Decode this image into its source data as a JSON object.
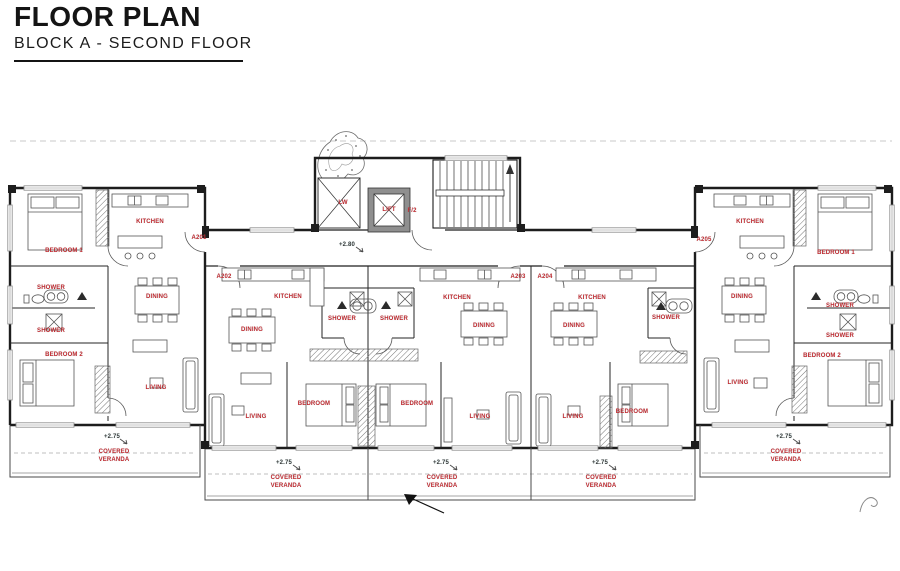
{
  "header": {
    "title": "FLOOR PLAN",
    "subtitle": "BLOCK A - SECOND FLOOR"
  },
  "colors": {
    "label_red": "#c1272d",
    "line_black": "#1d1d1d"
  },
  "core": {
    "light_well": "LW",
    "lift": "LIFT",
    "fire_door": "F/2",
    "corridor_elevation": "+2.80"
  },
  "apartments": [
    {
      "number": "A201",
      "rooms": {
        "bedroom1": "BEDROOM 1",
        "kitchen": "KITCHEN",
        "shower_top": "SHOWER",
        "dining": "DINING",
        "shower_bottom": "SHOWER",
        "bedroom2": "BEDROOM 2",
        "living": "LIVING"
      },
      "veranda": {
        "elevation": "+2.75",
        "label": "COVERED VERANDA"
      }
    },
    {
      "number": "A202",
      "rooms": {
        "kitchen": "KITCHEN",
        "shower": "SHOWER",
        "dining": "DINING",
        "bedroom": "BEDROOM",
        "living": "LIVING"
      },
      "veranda": {
        "elevation": "+2.75",
        "label": "COVERED VERANDA"
      }
    },
    {
      "number": "A203",
      "rooms": {
        "kitchen": "KITCHEN",
        "shower": "SHOWER",
        "dining": "DINING",
        "bedroom": "BEDROOM",
        "living": "LIVING"
      },
      "veranda": {
        "elevation": "+2.75",
        "label": "COVERED VERANDA"
      }
    },
    {
      "number": "A204",
      "rooms": {
        "kitchen": "KITCHEN",
        "shower": "SHOWER",
        "dining": "DINING",
        "bedroom": "BEDROOM",
        "living": "LIVING"
      },
      "veranda": {
        "elevation": "+2.75",
        "label": "COVERED VERANDA"
      }
    },
    {
      "number": "A205",
      "rooms": {
        "bedroom1": "BEDROOM 1",
        "kitchen": "KITCHEN",
        "shower_top": "SHOWER",
        "dining": "DINING",
        "shower_bottom": "SHOWER",
        "bedroom2": "BEDROOM 2",
        "living": "LIVING"
      },
      "veranda": {
        "elevation": "+2.75",
        "label": "COVERED VERANDA"
      }
    }
  ]
}
